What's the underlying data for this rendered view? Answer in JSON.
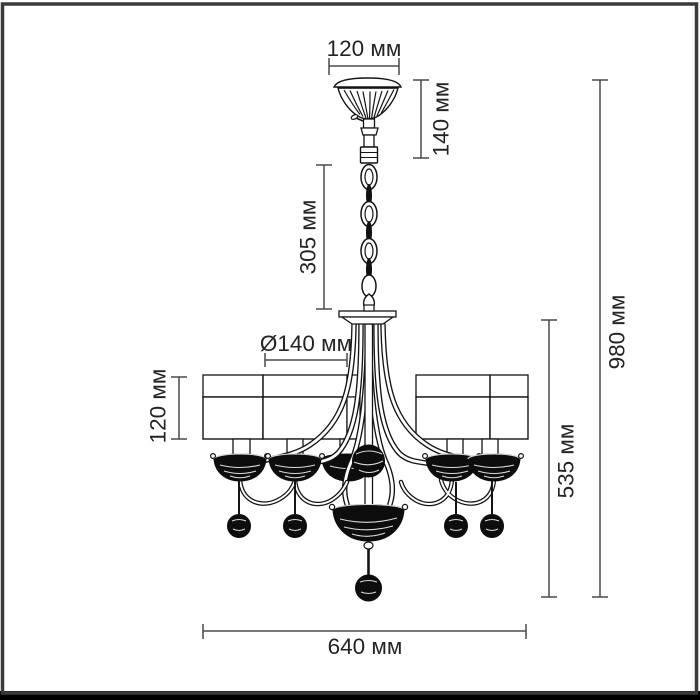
{
  "image": {
    "description": "Technical dimension line drawing of a chandelier with cylindrical shades hanging on a chain",
    "background": "#ffffff",
    "frame_color": "#3a3a3a",
    "bottom_bar_color": "#000000",
    "line_color": "#141414",
    "dimension_line_color": "#4a4a4a",
    "text_color": "#242424"
  },
  "units": "мм",
  "dimensions": {
    "canopy_width": "120 мм",
    "canopy_drop": "140 мм",
    "chain_length": "305 мм",
    "shade_diameter": "Ø140 мм",
    "shade_height": "120 мм",
    "body_height": "535 мм",
    "total_height": "980 мм",
    "total_width": "640 мм"
  }
}
